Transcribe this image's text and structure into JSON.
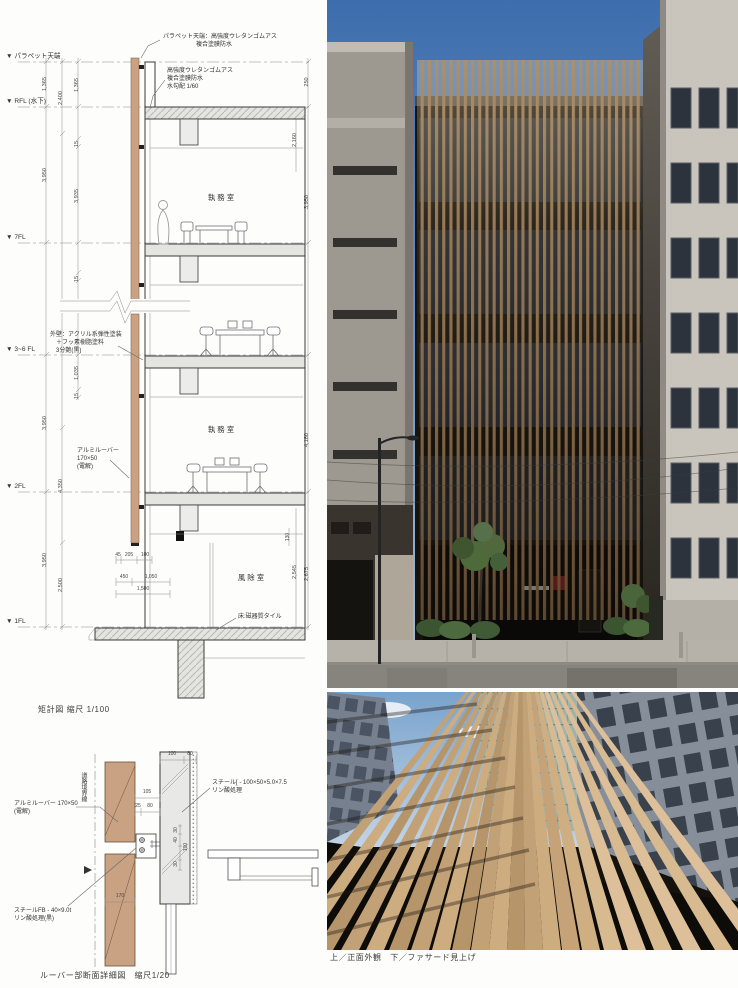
{
  "captions": {
    "section": "矩計図 縮尺 1/100",
    "detail": "ルーバー部断面詳細図　縮尺1/20",
    "photos": "上／正面外観　下／ファサード見上げ"
  },
  "section": {
    "levels": {
      "parapet": "▼ パラペット天端",
      "rfl": "▼ RFL (水下)",
      "f7": "▼ 7FL",
      "f36": "▼ 3~6 FL",
      "f2": "▼ 2FL",
      "f1": "▼ 1FL"
    },
    "ann": {
      "parapet1": "パラペット天端：高強度ウレタンゴムアス",
      "parapet2": "複合塗膜防水",
      "roof1": "高強度ウレタンゴムアス",
      "roof2": "複合塗膜防水",
      "roof3": "水勾配 1/60",
      "wall1": "外壁：アクリル系弾性塗装",
      "wall2": "＋フッ素樹脂塗料",
      "wall3": "3分艶(黒)",
      "louver1": "アルミルーバー",
      "louver2": "170×50",
      "louver3": "(電解)",
      "tile": "床:磁器質タイル",
      "office": "執務室",
      "wind": "風除室"
    },
    "dims": {
      "v1365a": "1,365",
      "v2400": "2,400",
      "v1365b": "1,365",
      "v15a": "15",
      "v3950a": "3,950",
      "v3935": "3,935",
      "v15b": "15",
      "v1035": "1,035",
      "v15c": "15",
      "v3950b": "3,950",
      "v4350": "4,350",
      "v3950c": "3,950",
      "v2500": "2,500",
      "v250": "250",
      "v2160": "2,160",
      "v3950r": "3,950",
      "v4180": "4,180",
      "v130": "130",
      "v2545": "2,545",
      "v2675": "2,675",
      "h45": "45",
      "h205": "205",
      "h100": "100",
      "h450": "450",
      "h1050": "1,050",
      "h1500": "1,500"
    }
  },
  "detail": {
    "labels": {
      "louver1": "アルミルーバー 170×50",
      "louver2": "(電解)",
      "steel1": "スチール[ - 100×50×5.0×7.5",
      "steel2": "リン酸処理",
      "fb1": "スチールFB - 40×9.0t",
      "fb2": "リン酸処理(黒)",
      "boundary": "道路境界線"
    },
    "dims": {
      "d100": "100",
      "d80": "80",
      "d105": "105",
      "d25": "25",
      "d80b": "80",
      "d30": "30",
      "d40": "40",
      "d100b": "100",
      "d30b": "30",
      "d170": "170"
    }
  },
  "colors": {
    "louver_wood": "#c9a183",
    "bronze_louver": "#8d6f4c",
    "sky_top": "#3d6dad",
    "accent_red": "#7e1d1d"
  }
}
